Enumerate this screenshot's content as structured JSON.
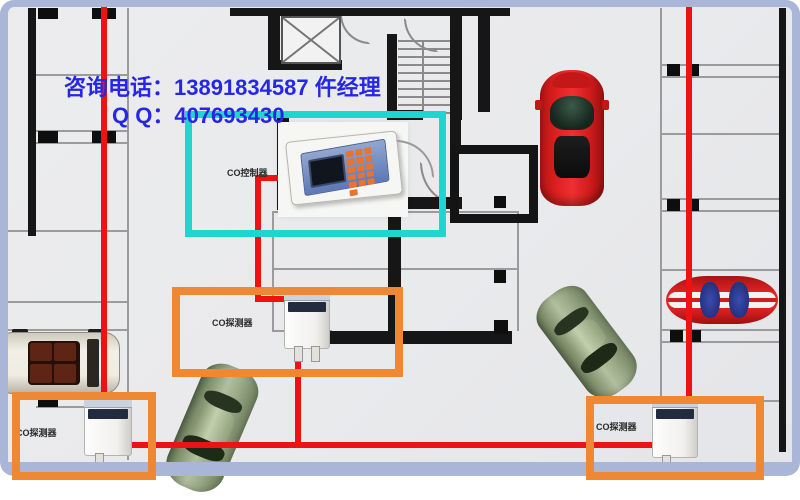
{
  "contact": {
    "phone_line": "咨询电话：13891834587 仵经理",
    "qq_line": "Q Q：407693430",
    "text_color": "#2626e6"
  },
  "devices": {
    "controller": {
      "label": "CO控制器"
    },
    "detector_mid": {
      "label": "CO探测器"
    },
    "detector_bottom_left": {
      "label": "CO探测器"
    },
    "detector_bottom_right": {
      "label": "CO探测器"
    }
  },
  "colors": {
    "highlight_cyan": "#1fd6cf",
    "highlight_orange": "#ef8832",
    "wire_red": "#ee1212",
    "frame_blue": "#a9b6d8",
    "wall_black": "#161616",
    "floor_gray": "#eaebed",
    "contact_blue": "#2626e6"
  },
  "icons": [
    "co-controller-device",
    "co-detector-device",
    "red-sports-car",
    "striped-race-car",
    "green-sedan",
    "white-suv",
    "elevator-shaft",
    "staircase"
  ]
}
